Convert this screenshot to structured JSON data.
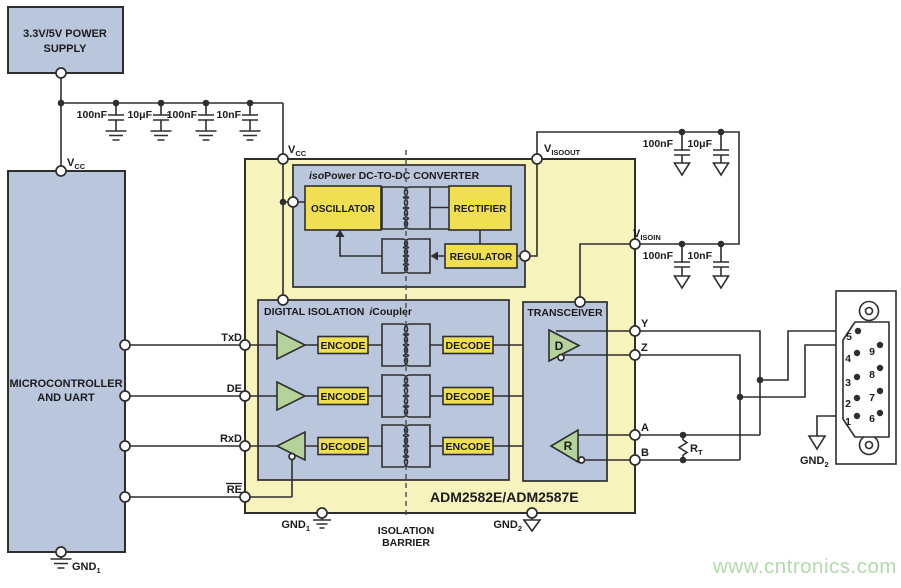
{
  "colors": {
    "block_fill": "#b9c6dc",
    "ic_fill": "#f7f3bd",
    "component_fill": "#f0df52",
    "buffer_fill": "#b4d29a",
    "wire": "#2e2e2e",
    "watermark": "#b4d9ae"
  },
  "power_supply": {
    "line1": "3.3V/5V POWER",
    "line2": "SUPPLY"
  },
  "microcontroller": {
    "line1": "MICROCONTROLLER",
    "line2": "AND UART"
  },
  "ic": {
    "part_number": "ADM2582E/ADM2587E",
    "dcdc": {
      "title_iso": "iso",
      "title_rest": "Power DC-TO-DC CONVERTER",
      "oscillator": "OSCILLATOR",
      "rectifier": "RECTIFIER",
      "regulator": "REGULATOR"
    },
    "digital_isolation": {
      "title": "DIGITAL ISOLATION",
      "icoupler_i": "i",
      "icoupler_rest": "Coupler",
      "encode": "ENCODE",
      "decode": "DECODE"
    },
    "transceiver": {
      "title": "TRANSCEIVER",
      "driver": "D",
      "receiver": "R"
    }
  },
  "signals": {
    "vcc": {
      "base": "V",
      "sub": "CC"
    },
    "visoout": {
      "base": "V",
      "sub": "ISOOUT"
    },
    "visoin": {
      "base": "V",
      "sub": "ISOIN"
    },
    "gnd1": {
      "base": "GND",
      "sub": "1"
    },
    "gnd2": {
      "base": "GND",
      "sub": "2"
    },
    "txd": "TxD",
    "de": "DE",
    "rxd": "RxD",
    "re": "RE",
    "y": "Y",
    "z": "Z",
    "a": "A",
    "b": "B",
    "rt": {
      "base": "R",
      "sub": "T"
    }
  },
  "capacitors": {
    "vcc_rail": [
      "100nF",
      "10μF",
      "100nF",
      "10nF"
    ],
    "visoout_rail": [
      "100nF",
      "10μF"
    ],
    "visoin_rail": [
      "100nF",
      "10nF"
    ]
  },
  "isolation_barrier": {
    "line1": "ISOLATION",
    "line2": "BARRIER"
  },
  "connector": {
    "pins_left": [
      "5",
      "4",
      "3",
      "2",
      "1"
    ],
    "pins_right": [
      "9",
      "8",
      "7",
      "6"
    ]
  },
  "watermark": "www.cntronics.com"
}
